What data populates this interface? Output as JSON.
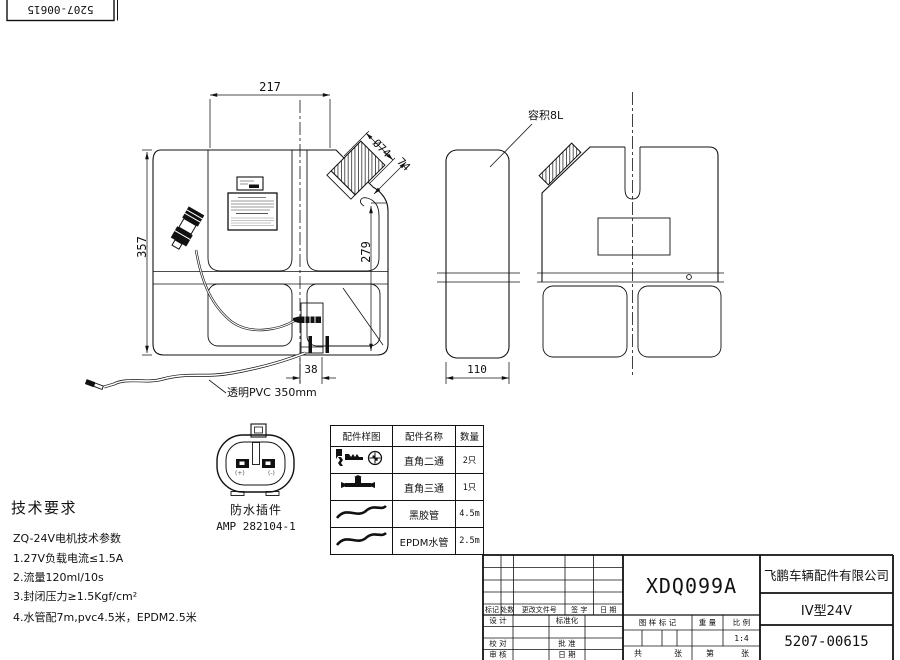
{
  "corner_stamp": {
    "part_no": "5207-00615"
  },
  "dimensions": {
    "top_width": "217",
    "overall_height": "357",
    "right_height": "279",
    "neck_diameter": "Ø74",
    "neck_length": "74",
    "outlet_width": "38",
    "side_width": "110"
  },
  "callouts": {
    "capacity": "容积8L",
    "tube": "透明PVC 350mm"
  },
  "connector_detail": {
    "caption": "防水插件",
    "model": "AMP 282104-1",
    "plus": "(+)",
    "minus": "(-)"
  },
  "parts_table": {
    "headers": [
      "配件样图",
      "配件名称",
      "数量"
    ],
    "rows": [
      {
        "sample": "right-angle-two-way-fitting",
        "name": "直角二通",
        "qty": "2只"
      },
      {
        "sample": "right-angle-three-way-fitting",
        "name": "直角三通",
        "qty": "1只"
      },
      {
        "sample": "hose-curve",
        "name": "黑胶管",
        "qty": "4.5m"
      },
      {
        "sample": "hose-curve",
        "name": "EPDM水管",
        "qty": "2.5m"
      }
    ]
  },
  "tech_requirements": {
    "title": "技术要求",
    "subtitle": "ZQ-24V电机技术参数",
    "items": [
      "1.27V负载电流≤1.5A",
      "2.流量120ml/10s",
      "3.封闭压力≥1.5Kgf/cm²",
      "4.水管配7m,pvc4.5米，EPDM2.5米"
    ]
  },
  "title_block": {
    "drawing_code": "XDQ099A",
    "company": "飞鹏车辆配件有限公司",
    "model": "IV型24V",
    "part_no": "5207-00615",
    "scale_value": "1:4",
    "labels": {
      "mark": "标记",
      "qty": "处数",
      "change_doc": "更改文件号",
      "sign": "签 字",
      "date": "日 期",
      "design": "设 计",
      "standardization": "标准化",
      "proofread": "校 对",
      "approve": "批 准",
      "review": "审 核",
      "date2": "日 期",
      "drawing_mark": "图 样 标 记",
      "weight": "重 量",
      "scale": "比 例",
      "total": "共",
      "sheets": "张",
      "no": "第",
      "sheet2": "张"
    }
  }
}
